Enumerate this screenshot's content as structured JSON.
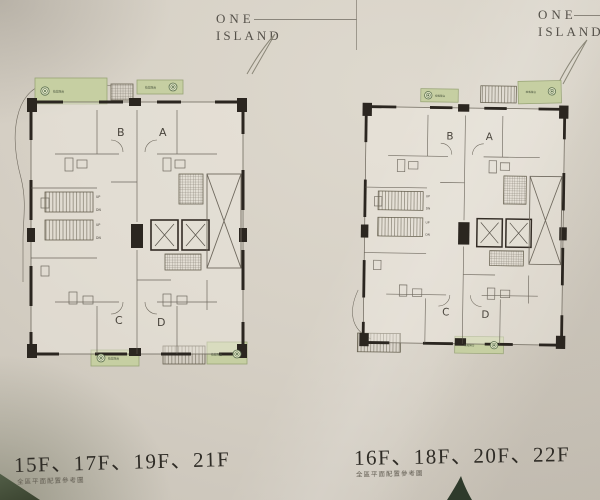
{
  "brand": {
    "line1": "ONE",
    "line2": "ISLAND"
  },
  "left_page": {
    "floors_label": "15F、17F、19F、21F",
    "caption": "全區平面配置參考圖",
    "units": {
      "a": "A",
      "b": "B",
      "c": "C",
      "d": "D"
    },
    "stairs": {
      "up": "UP",
      "dn": "DN"
    },
    "balcony_label": "植栽陽台"
  },
  "right_page": {
    "floors_label": "16F、18F、20F、22F",
    "caption": "全區平面配置參考圖",
    "units": {
      "a": "A",
      "b": "B",
      "c": "C",
      "d": "D"
    },
    "stairs": {
      "up": "UP",
      "dn": "DN"
    },
    "balcony_label": "植栽陽台"
  },
  "colors": {
    "paper": "#d6d0c5",
    "wall": "#2b2620",
    "plan_line": "#6f695e",
    "balcony_green": "#c6cfa2",
    "balcony_green_border": "#98a476",
    "flower_green": "#5c7050",
    "text_dark": "#2f2c26",
    "text_muted": "#625d52",
    "leaf_dark": "#2e3a2b"
  }
}
